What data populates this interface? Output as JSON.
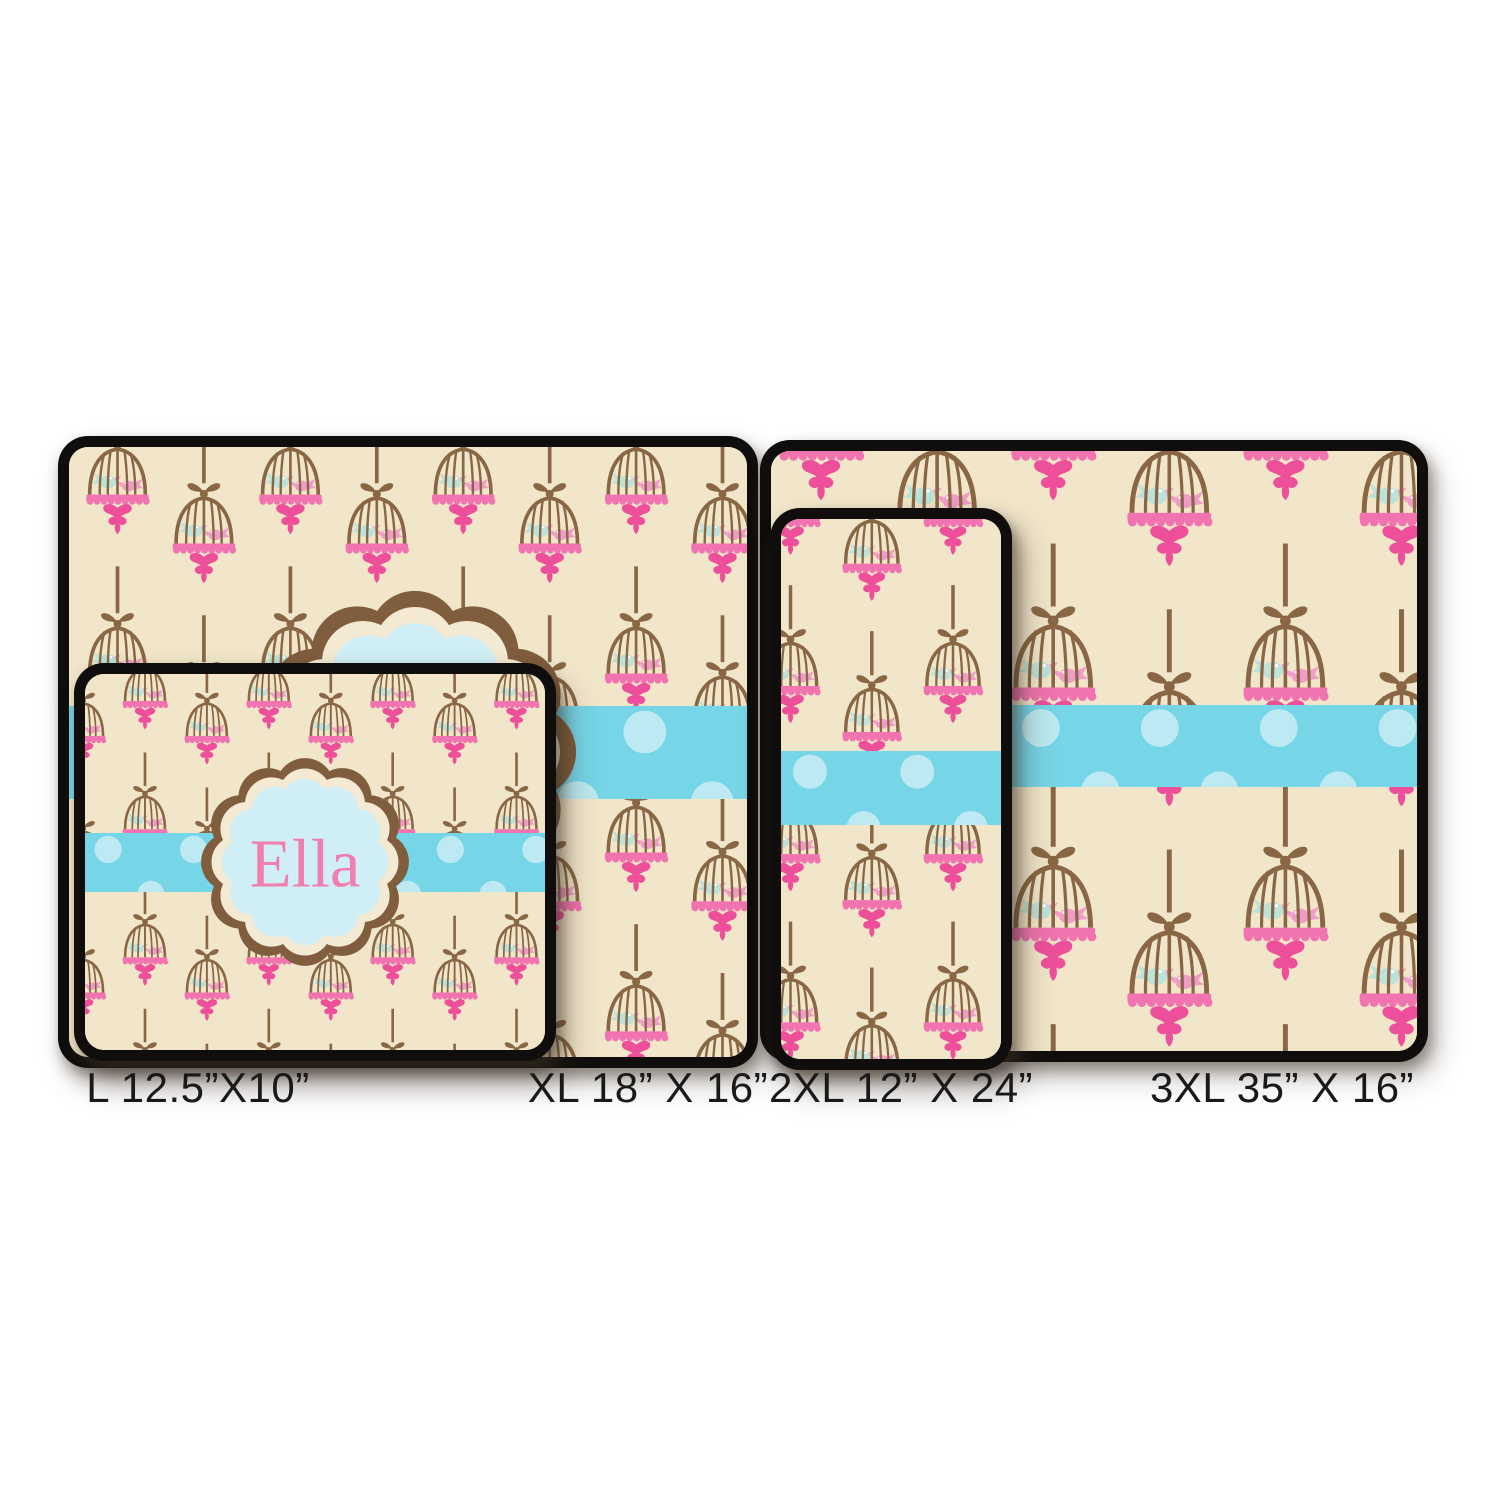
{
  "product": {
    "name": "Ella",
    "description": "Personalized hanging birdcage / kissing love-birds pattern mat shown in four sizes"
  },
  "sizes": [
    {
      "id": "L",
      "label": "L 12.5”X10”"
    },
    {
      "id": "XL",
      "label": "XL 18” X 16”"
    },
    {
      "id": "2XL",
      "label": "2XL 12” X 24”"
    },
    {
      "id": "3XL",
      "label": "3XL 35” X 16”"
    }
  ],
  "colors": {
    "canvas": "#ffffff",
    "mat_border": "#0f0e0c",
    "mat_background": "#f1e6ca",
    "cage_brown": "#8a6744",
    "pink_base": "#f173af",
    "pink_flourish": "#ee4f9a",
    "bird_blue": "#bce2d9",
    "bird_pink": "#f19cc8",
    "ribbon_blue": "#76d5e7",
    "ribbon_dot": "#bdeaf2",
    "badge_fill": "#cfeef5",
    "badge_ring": "#f4ead3",
    "badge_border": "#7f5d3d",
    "name_text": "#f07fb0",
    "label_text": "#191919"
  },
  "icons": {
    "motif": "birdcage-with-love-birds-icon",
    "ribbon": "polka-dot-ribbon",
    "badge": "scalloped-badge"
  }
}
